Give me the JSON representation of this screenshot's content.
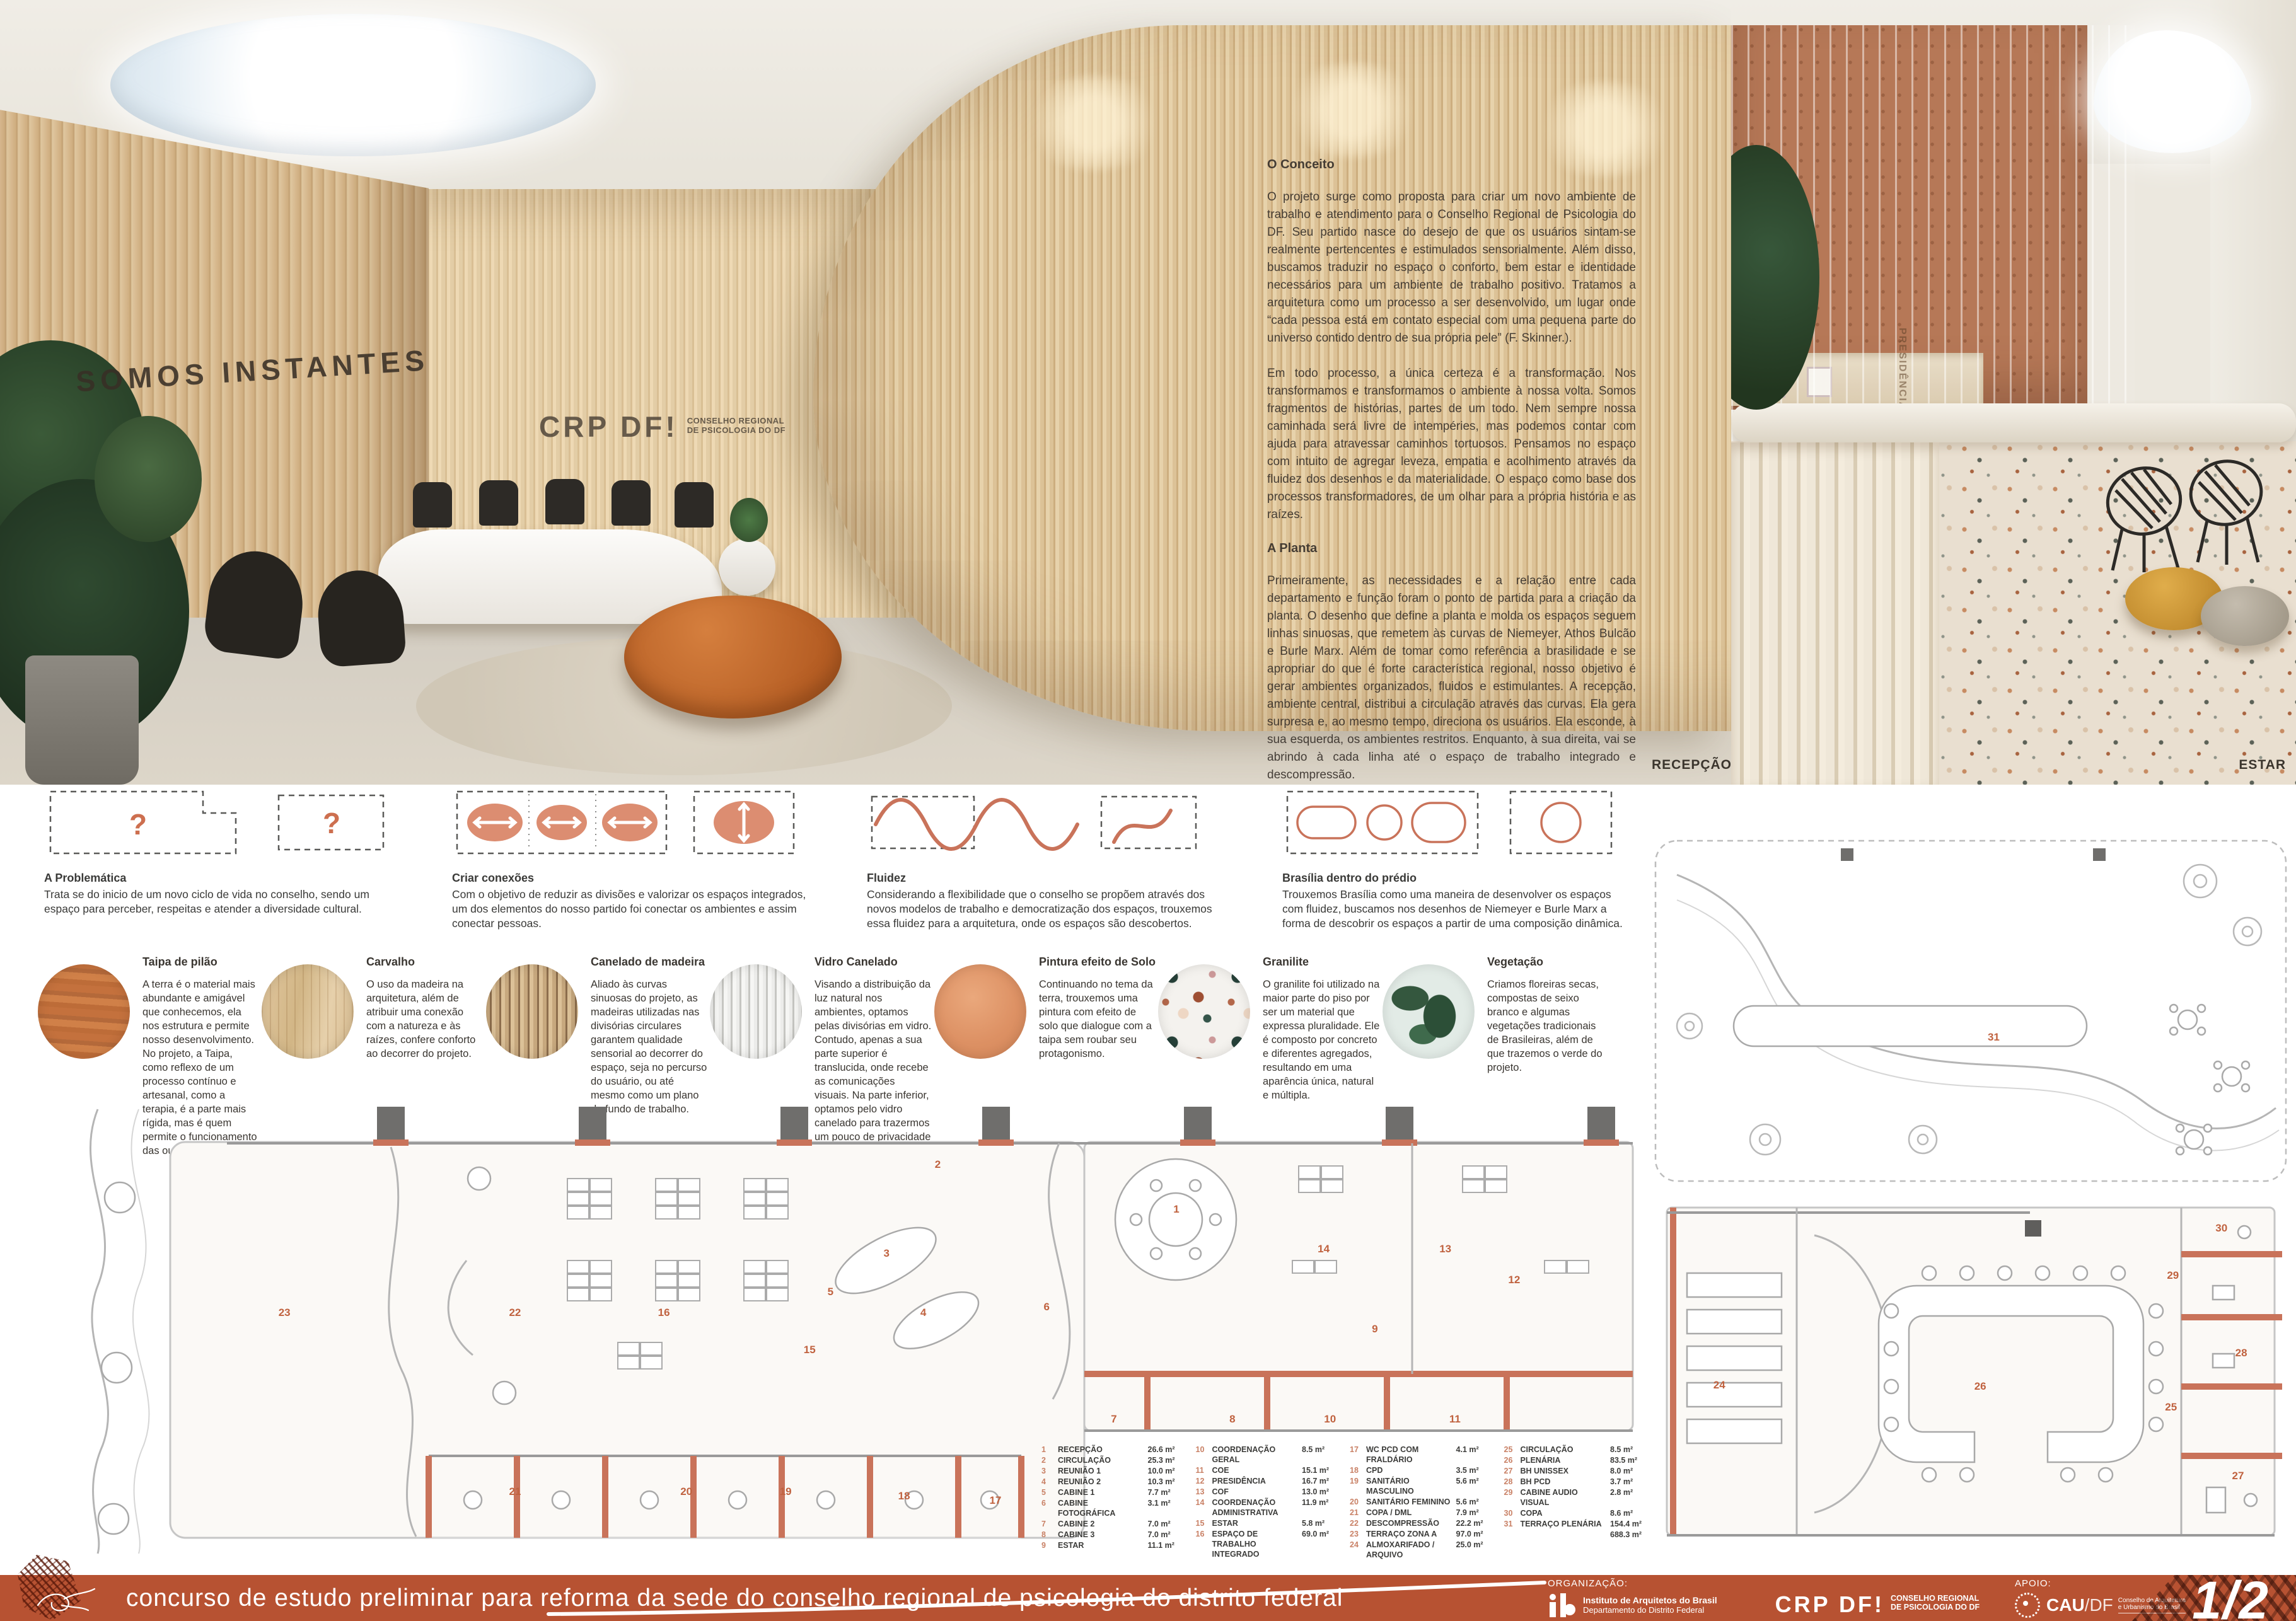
{
  "colors": {
    "accent_terracotta": "#b75232",
    "plan_salmon": "#c9735a",
    "number_salmon": "#c0623f",
    "wood": "#d8ba90"
  },
  "renders": {
    "left": {
      "wall_sign": "SOMOS INSTANTES",
      "logo": "CRP DF!",
      "logo_sub1": "CONSELHO REGIONAL",
      "logo_sub2": "DE PSICOLOGIA DO DF",
      "label": "RECEPÇÃO"
    },
    "right": {
      "label": "ESTAR",
      "glass_label": "PRESIDÊNCIA"
    }
  },
  "concept": {
    "title": "O Conceito",
    "p1": "O projeto surge como proposta para criar um novo ambiente de trabalho e atendimento para o Conselho Regional de Psicologia do DF. Seu partido nasce do desejo de que os usuários sintam-se realmente pertencentes e estimulados sensorialmente. Além disso, buscamos traduzir no espaço o conforto, bem estar e identidade necessários para um ambiente de trabalho positivo. Tratamos a arquitetura como um processo a ser desenvolvido, um lugar onde “cada pessoa está em contato especial com uma pequena parte do universo contido dentro de sua própria pele” (F. Skinner.).",
    "p2": "Em todo processo, a única certeza é a transformação. Nos transformamos e transformamos o ambiente à nossa volta. Somos fragmentos de histórias, partes de um todo. Nem sempre nossa caminhada será livre de intempéries, mas podemos contar com ajuda para atravessar caminhos tortuosos. Pensamos no espaço com intuito de agregar leveza, empatia e acolhimento através da fluidez dos desenhos e da materialidade. O espaço como base dos processos transformadores, de um olhar para a própria história e as raízes.",
    "title2": "A Planta",
    "p3": "Primeiramente, as necessidades e a relação entre cada departamento e função foram o ponto de partida para a criação da planta. O desenho que define a planta e molda os espaços seguem linhas sinuosas, que remetem às curvas de Niemeyer, Athos Bulcão e Burle Marx. Além de tomar como referência a brasilidade e se apropriar do que é forte característica regional, nosso objetivo é gerar ambientes organizados, fluidos e estimulantes. A recepção, ambiente central, distribui a circulação através das curvas. Ela gera surpresa e, ao mesmo tempo, direciona os usuários. Ela esconde, à sua esquerda, os ambientes restritos. Enquanto, à sua direita, vai se abrindo à cada linha até o espaço de trabalho integrado e descompressão."
  },
  "diagrams": [
    {
      "title": "A Problemática",
      "text": "Trata se do inicio de um novo ciclo de vida no conselho, sendo um espaço para perceber, respeitas e atender a diversidade cultural."
    },
    {
      "title": "Criar conexões",
      "text": "Com o objetivo de reduzir as divisões e valorizar os espaços integrados, um dos elementos do nosso partido foi conectar os ambientes e assim conectar pessoas."
    },
    {
      "title": "Fluidez",
      "text": "Considerando a flexibilidade que o conselho se propõem através dos novos modelos de trabalho e democratização dos espaços, trouxemos essa fluidez para a arquitetura, onde os espaços são descobertos."
    },
    {
      "title": "Brasília dentro do prédio",
      "text": "Trouxemos Brasília como uma maneira de desenvolver os espaços com fluidez, buscamos nos desenhos de Niemeyer e Burle Marx a forma de descobrir os espaços a partir de uma composição dinâmica."
    }
  ],
  "materials": [
    {
      "title": "Taipa de pilão",
      "text": "A terra é o material mais abundante e amigável que conhecemos, ela nos estrutura e permite nosso desenvolvimento. No projeto, a Taipa, como reflexo de um processo contínuo e artesanal, como a terapia, é a parte mais rígida, mas é quem permite o funcionamento das outras áreas."
    },
    {
      "title": "Carvalho",
      "text": "O uso da madeira na arquitetura, além de atribuir uma conexão com a natureza e às raízes, confere conforto ao decorrer do projeto."
    },
    {
      "title": "Canelado de madeira",
      "text": "Aliado às curvas sinuosas do projeto, as madeiras utilizadas nas divisórias circulares garantem qualidade sensorial ao decorrer do espaço, seja no percurso do usuário, ou até mesmo como um plano de fundo de trabalho."
    },
    {
      "title": "Vidro Canelado",
      "text": "Visando a distribuição da luz natural nos ambientes, optamos pelas divisórias em vidro. Contudo, apenas a sua parte superior é translucida, onde recebe as comunicações visuais. Na parte inferior, optamos pelo vidro canelado para trazermos um pouco de privacidade e potencializarmos os percursos sensoriais."
    },
    {
      "title": "Pintura efeito de Solo",
      "text": "Continuando no tema da terra, trouxemos uma pintura com efeito de solo que dialogue com a taipa sem roubar seu protagonismo."
    },
    {
      "title": "Granilite",
      "text": "O granilite foi utilizado na maior parte do piso por ser um material que expressa pluralidade. Ele é composto por concreto e diferentes agregados, resultando em uma aparência única, natural e múltipla."
    },
    {
      "title": "Vegetação",
      "text": "Criamos floreiras secas, compostas de seixo branco e algumas vegetações tradicionais de Brasileiras, além de que trazemos o verde do projeto."
    }
  ],
  "legend": {
    "columns": [
      [
        [
          "1",
          "RECEPÇÃO",
          "26.6 m²"
        ],
        [
          "2",
          "CIRCULAÇÃO",
          "25.3 m²"
        ],
        [
          "3",
          "REUNIÃO 1",
          "10.0 m²"
        ],
        [
          "4",
          "REUNIÃO 2",
          "10.3 m²"
        ],
        [
          "5",
          "CABINE 1",
          "7.7 m²"
        ],
        [
          "6",
          "CABINE FOTOGRÁFICA",
          "3.1 m²"
        ],
        [
          "7",
          "CABINE 2",
          "7.0 m²"
        ],
        [
          "8",
          "CABINE 3",
          "7.0 m²"
        ],
        [
          "9",
          "ESTAR",
          "11.1 m²"
        ]
      ],
      [
        [
          "10",
          "COORDENAÇÃO GERAL",
          "8.5 m²"
        ],
        [
          "11",
          "COE",
          "15.1 m²"
        ],
        [
          "12",
          "PRESIDÊNCIA",
          "16.7 m²"
        ],
        [
          "13",
          "COF",
          "13.0 m²"
        ],
        [
          "14",
          "COORDENAÇÃO ADMINISTRATIVA",
          "11.9 m²"
        ],
        [
          "15",
          "ESTAR",
          "5.8 m²"
        ],
        [
          "16",
          "ESPAÇO DE TRABALHO INTEGRADO",
          "69.0 m²"
        ]
      ],
      [
        [
          "17",
          "WC PCD COM FRALDÁRIO",
          "4.1 m²"
        ],
        [
          "18",
          "CPD",
          "3.5 m²"
        ],
        [
          "19",
          "SANITÁRIO MASCULINO",
          "5.6 m²"
        ],
        [
          "20",
          "SANITÁRIO FEMININO",
          "5.6 m²"
        ],
        [
          "21",
          "COPA / DML",
          "7.9 m²"
        ],
        [
          "22",
          "DESCOMPRESSÃO",
          "22.2 m²"
        ],
        [
          "23",
          "TERRAÇO ZONA A",
          "97.0 m²"
        ],
        [
          "24",
          "ALMOXARIFADO / ARQUIVO",
          "25.0 m²"
        ]
      ],
      [
        [
          "25",
          "CIRCULAÇÃO",
          "8.5 m²"
        ],
        [
          "26",
          "PLENÁRIA",
          "83.5 m²"
        ],
        [
          "27",
          "BH UNISSEX",
          "8.0 m²"
        ],
        [
          "28",
          "BH PCD",
          "3.7 m²"
        ],
        [
          "29",
          "CABINE AUDIO VISUAL",
          "2.8 m²"
        ],
        [
          "30",
          "COPA",
          "8.6 m²"
        ],
        [
          "31",
          "TERRAÇO PLENÁRIA",
          "154.4 m²"
        ],
        [
          "",
          "",
          "688.3 m²"
        ]
      ]
    ]
  },
  "plan_numbers": {
    "main": [
      {
        "n": "1",
        "x": 71.1,
        "y": 23.5
      },
      {
        "n": "2",
        "x": 56.2,
        "y": 13.6
      },
      {
        "n": "3",
        "x": 53.0,
        "y": 33.2
      },
      {
        "n": "4",
        "x": 55.3,
        "y": 46.3
      },
      {
        "n": "5",
        "x": 49.5,
        "y": 41.7
      },
      {
        "n": "6",
        "x": 63.0,
        "y": 45.0
      },
      {
        "n": "7",
        "x": 67.2,
        "y": 69.7
      },
      {
        "n": "8",
        "x": 74.6,
        "y": 69.7
      },
      {
        "n": "9",
        "x": 83.5,
        "y": 49.9
      },
      {
        "n": "10",
        "x": 80.7,
        "y": 69.7
      },
      {
        "n": "11",
        "x": 88.5,
        "y": 69.7
      },
      {
        "n": "12",
        "x": 92.2,
        "y": 39.0
      },
      {
        "n": "13",
        "x": 87.9,
        "y": 32.2
      },
      {
        "n": "14",
        "x": 80.3,
        "y": 32.2
      },
      {
        "n": "15",
        "x": 48.2,
        "y": 54.4
      },
      {
        "n": "16",
        "x": 39.1,
        "y": 46.3
      },
      {
        "n": "17",
        "x": 59.8,
        "y": 87.6
      },
      {
        "n": "18",
        "x": 54.1,
        "y": 86.7
      },
      {
        "n": "19",
        "x": 46.7,
        "y": 85.7
      },
      {
        "n": "20",
        "x": 40.5,
        "y": 85.7
      },
      {
        "n": "21",
        "x": 29.8,
        "y": 85.7
      },
      {
        "n": "22",
        "x": 29.8,
        "y": 46.3
      },
      {
        "n": "23",
        "x": 15.4,
        "y": 46.3
      }
    ],
    "terrace": [
      {
        "n": "31",
        "x": 53.6,
        "y": 57.6
      }
    ],
    "plenary": [
      {
        "n": "24",
        "x": 10.6,
        "y": 54.8
      },
      {
        "n": "25",
        "x": 81.4,
        "y": 60.9
      },
      {
        "n": "26",
        "x": 51.5,
        "y": 55.2
      },
      {
        "n": "27",
        "x": 91.9,
        "y": 79.7
      },
      {
        "n": "28",
        "x": 92.4,
        "y": 46.0
      },
      {
        "n": "29",
        "x": 81.7,
        "y": 24.8
      },
      {
        "n": "30",
        "x": 89.3,
        "y": 11.9
      }
    ]
  },
  "footer": {
    "title": "concurso de estudo preliminar para reforma da sede do conselho regional de psicologia do distrito federal",
    "org_label": "ORGANIZAÇÃO:",
    "apoio_label": "APOIO:",
    "iab_name": "Instituto de Arquitetos do Brasil",
    "iab_sub": "Departamento do Distrito Federal",
    "crp_logo": "CRP DF!",
    "crp_sub1": "CONSELHO REGIONAL",
    "crp_sub2": "DE PSICOLOGIA DO DF",
    "cau_logo": "CAU",
    "cau_suffix": "/DF",
    "cau_sub1": "Conselho de Arquitetura",
    "cau_sub2": "e Urbanismo do Brasil",
    "page": "1/2"
  }
}
